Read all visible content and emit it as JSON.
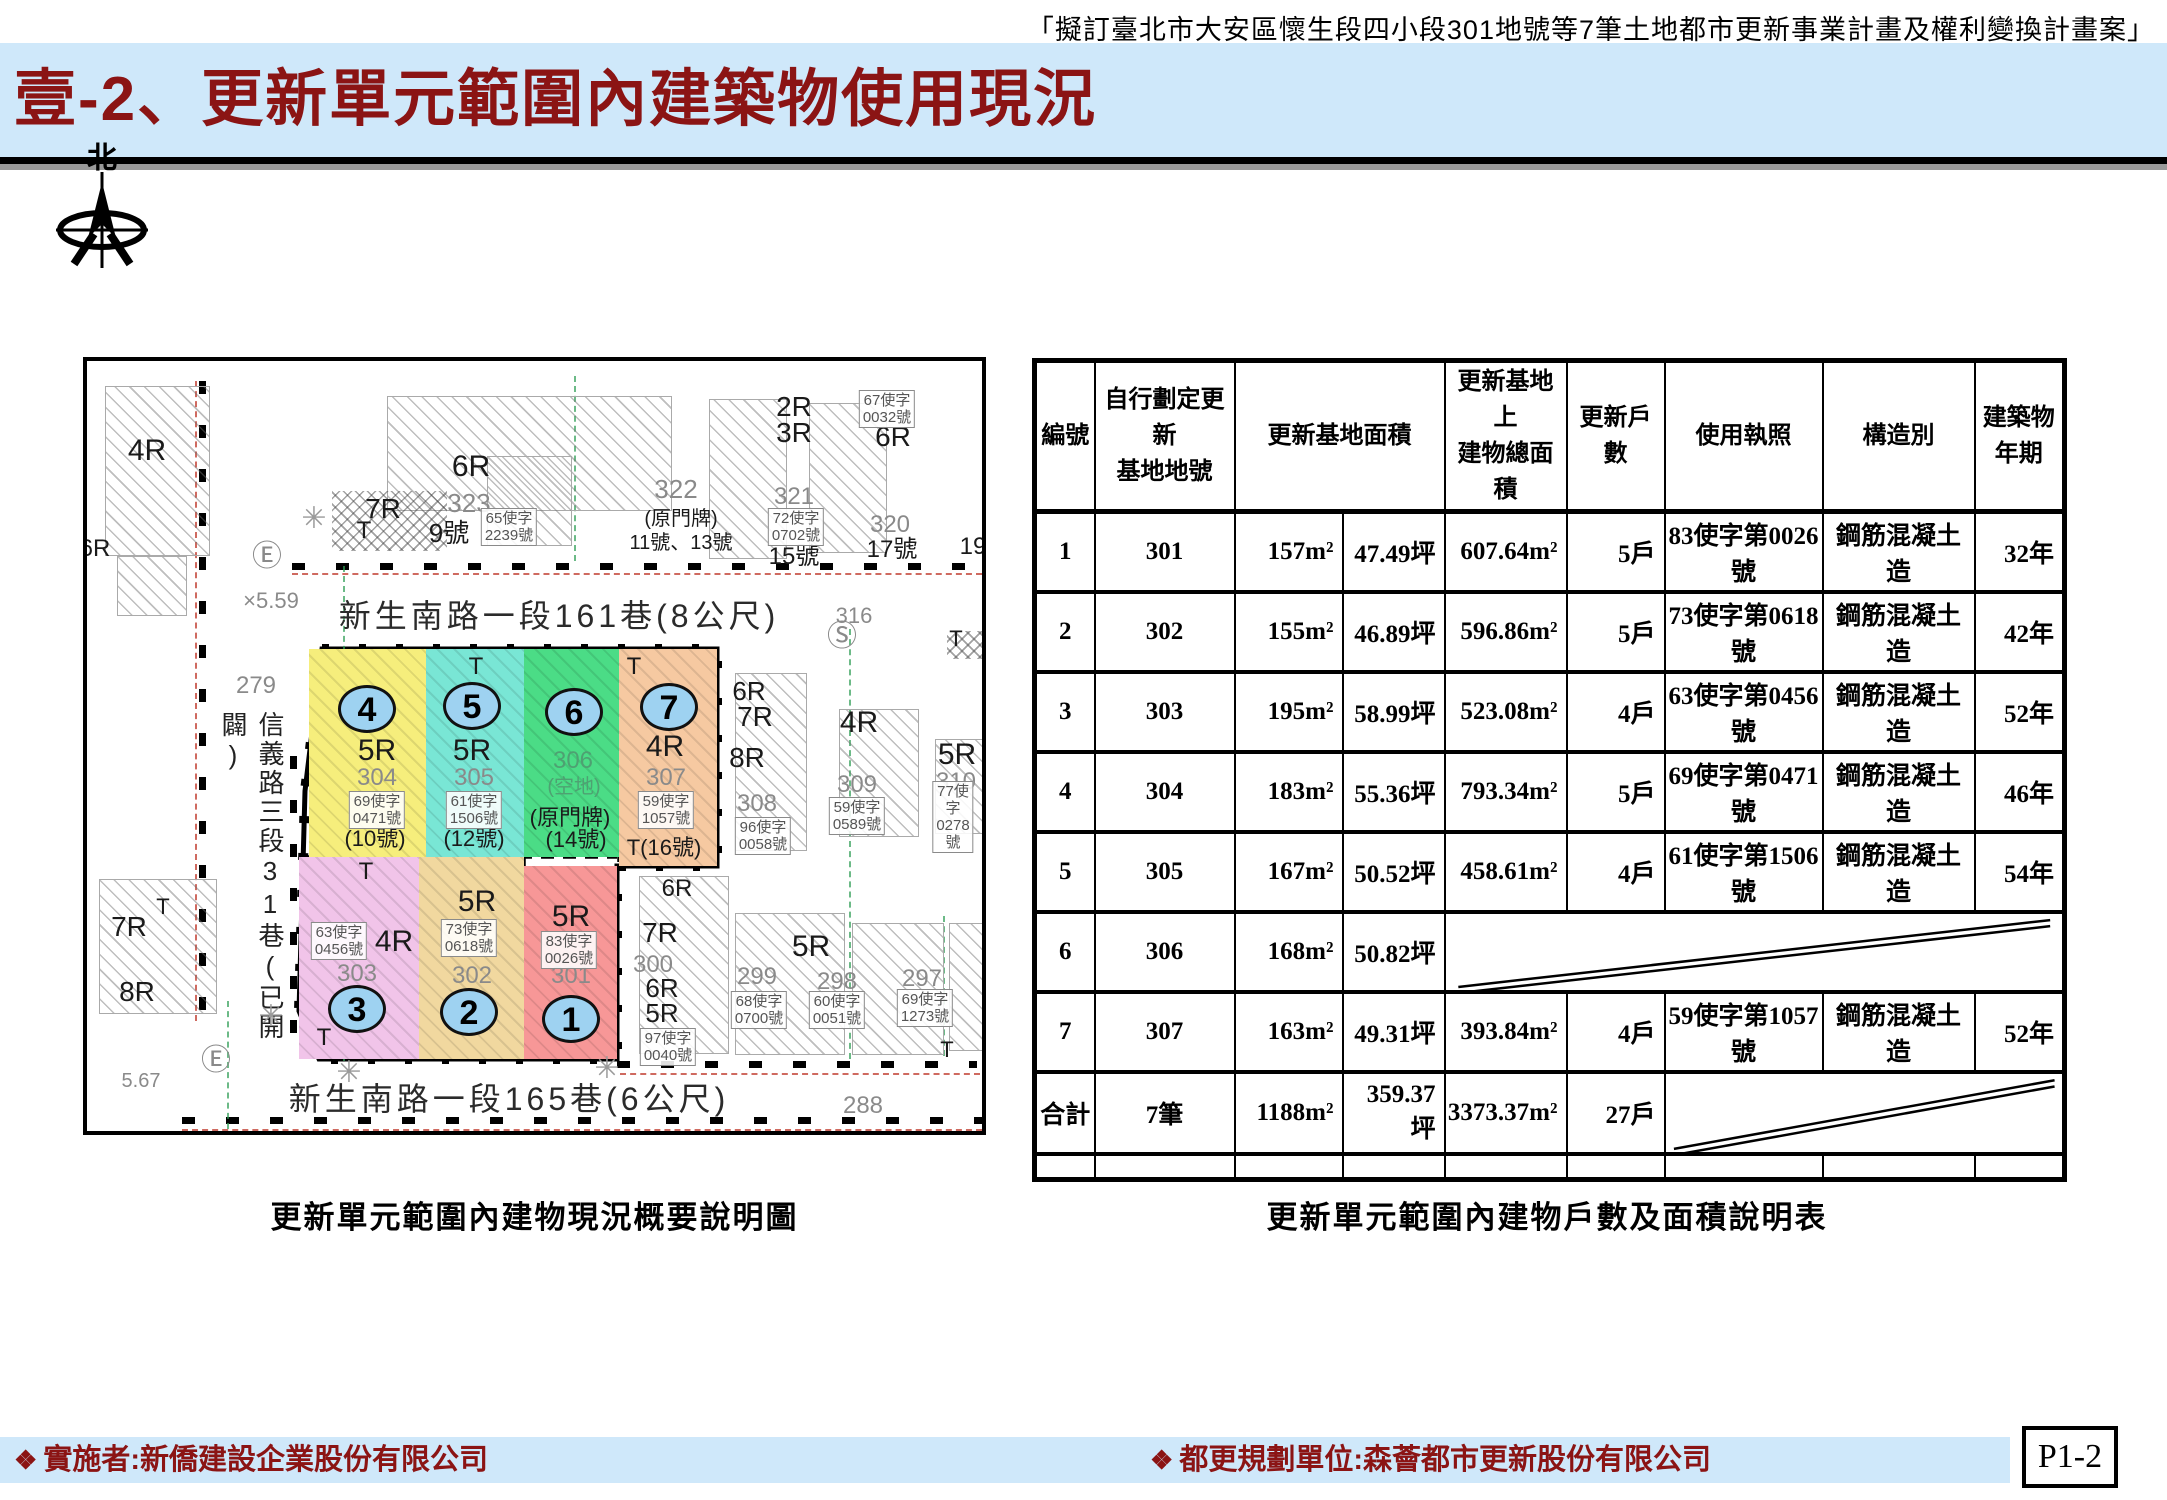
{
  "header": {
    "doc_ref": "「擬訂臺北市大安區懷生段四小段301地號等7筆土地都市更新事業計畫及權利變換計畫案」",
    "title": "壹-2、更新單元範圍內建築物使用現況",
    "accent_color": "#8b1414",
    "band_color": "#cfe8fa"
  },
  "compass": {
    "north_label": "北"
  },
  "map_caption": "更新單元範圍內建物現況概要說明圖",
  "table_caption": "更新單元範圍內建物戶數及面積說明表",
  "map": {
    "roads": [
      {
        "t": "新生南路一段161巷(8公尺)",
        "x": 472,
        "y": 253
      },
      {
        "t": "新生南路一段165巷(6公尺)",
        "x": 422,
        "y": 736
      }
    ],
    "street_vertical": "信義路三段31巷(已開闢)",
    "unit_outline": [
      [
        235,
        288
      ],
      [
        630,
        288
      ],
      [
        630,
        505
      ],
      [
        530,
        505
      ],
      [
        530,
        698
      ],
      [
        232,
        698
      ],
      [
        212,
        650
      ],
      [
        218,
        430
      ]
    ],
    "unit_dashes": [
      [
        339,
        290,
        339,
        496
      ],
      [
        437,
        290,
        437,
        496
      ],
      [
        532,
        290,
        532,
        503
      ],
      [
        212,
        496,
        530,
        496
      ],
      [
        332,
        496,
        332,
        696
      ],
      [
        437,
        496,
        437,
        696
      ]
    ],
    "parcels": [
      {
        "no": "4",
        "color": "#f6ee7c",
        "x": 222,
        "y": 288,
        "w": 117,
        "h": 208,
        "cx": 280,
        "cy": 348
      },
      {
        "no": "5",
        "color": "#79e6d5",
        "x": 339,
        "y": 288,
        "w": 98,
        "h": 208,
        "cx": 385,
        "cy": 345
      },
      {
        "no": "6",
        "color": "#4bdc86",
        "x": 437,
        "y": 288,
        "w": 95,
        "h": 208,
        "cx": 487,
        "cy": 351
      },
      {
        "no": "7",
        "color": "#f6c9a1",
        "x": 532,
        "y": 288,
        "w": 98,
        "h": 217,
        "cx": 582,
        "cy": 346
      },
      {
        "no": "3",
        "color": "#f1c4e9",
        "x": 212,
        "y": 496,
        "w": 120,
        "h": 202,
        "cx": 270,
        "cy": 648
      },
      {
        "no": "2",
        "color": "#f1d89f",
        "x": 332,
        "y": 496,
        "w": 105,
        "h": 202,
        "cx": 382,
        "cy": 651
      },
      {
        "no": "1",
        "color": "#f79797",
        "x": 437,
        "y": 505,
        "w": 93,
        "h": 193,
        "cx": 484,
        "cy": 658
      }
    ],
    "buildings": [
      {
        "x": 18,
        "y": 25,
        "w": 105,
        "h": 170
      },
      {
        "x": 30,
        "y": 195,
        "w": 70,
        "h": 60
      },
      {
        "x": 300,
        "y": 35,
        "w": 285,
        "h": 115
      },
      {
        "x": 400,
        "y": 95,
        "w": 85,
        "h": 90
      },
      {
        "x": 622,
        "y": 38,
        "w": 78,
        "h": 160
      },
      {
        "x": 722,
        "y": 42,
        "w": 78,
        "h": 150
      },
      {
        "x": 860,
        "y": 270,
        "w": 42,
        "h": 28,
        "cross": true
      },
      {
        "x": 648,
        "y": 312,
        "w": 72,
        "h": 178
      },
      {
        "x": 752,
        "y": 348,
        "w": 80,
        "h": 128
      },
      {
        "x": 848,
        "y": 378,
        "w": 80,
        "h": 95
      },
      {
        "x": 12,
        "y": 518,
        "w": 118,
        "h": 135
      },
      {
        "x": 552,
        "y": 515,
        "w": 90,
        "h": 178
      },
      {
        "x": 648,
        "y": 552,
        "w": 110,
        "h": 142
      },
      {
        "x": 765,
        "y": 562,
        "w": 92,
        "h": 132
      },
      {
        "x": 862,
        "y": 562,
        "w": 68,
        "h": 128
      },
      {
        "x": 245,
        "y": 130,
        "w": 115,
        "h": 60,
        "cross": true
      },
      {
        "x": 339,
        "y": 288,
        "w": 98,
        "h": 24,
        "cross": true
      },
      {
        "x": 532,
        "y": 288,
        "w": 34,
        "h": 30,
        "cross": true
      },
      {
        "x": 212,
        "y": 496,
        "w": 120,
        "h": 28,
        "cross": true
      },
      {
        "x": 218,
        "y": 648,
        "w": 55,
        "h": 40,
        "cross": true
      }
    ],
    "labels": [
      {
        "t": "4R",
        "x": 60,
        "y": 90,
        "s": 30
      },
      {
        "t": "7R",
        "x": 296,
        "y": 148,
        "s": 28
      },
      {
        "t": "T",
        "x": 277,
        "y": 170,
        "s": 24
      },
      {
        "t": "6R",
        "x": 384,
        "y": 106,
        "s": 30
      },
      {
        "t": "323",
        "x": 382,
        "y": 142,
        "s": 26,
        "c": "g"
      },
      {
        "t": "9號",
        "x": 362,
        "y": 172,
        "s": 26
      },
      {
        "t": "322",
        "x": 589,
        "y": 128,
        "s": 26,
        "c": "g"
      },
      {
        "t": "(原門牌)",
        "x": 594,
        "y": 158,
        "s": 20
      },
      {
        "t": "11號、13號",
        "x": 594,
        "y": 182,
        "s": 20
      },
      {
        "t": "2R",
        "x": 707,
        "y": 46,
        "s": 28
      },
      {
        "t": "3R",
        "x": 707,
        "y": 72,
        "s": 28
      },
      {
        "t": "6R",
        "x": 806,
        "y": 76,
        "s": 28
      },
      {
        "t": "321",
        "x": 707,
        "y": 136,
        "s": 24,
        "c": "g"
      },
      {
        "t": "15號",
        "x": 707,
        "y": 196,
        "s": 24
      },
      {
        "t": "320",
        "x": 803,
        "y": 164,
        "s": 24,
        "c": "g"
      },
      {
        "t": "17號",
        "x": 805,
        "y": 189,
        "s": 24
      },
      {
        "t": "19",
        "x": 886,
        "y": 186,
        "s": 24
      },
      {
        "t": "316",
        "x": 767,
        "y": 255,
        "s": 22,
        "c": "g"
      },
      {
        "t": "Ⓢ",
        "x": 755,
        "y": 276,
        "s": 30,
        "c": "g"
      },
      {
        "t": "Ⓔ",
        "x": 180,
        "y": 196,
        "s": 30,
        "c": "g"
      },
      {
        "t": "×5.59",
        "x": 184,
        "y": 240,
        "s": 22,
        "c": "g"
      },
      {
        "t": "279",
        "x": 169,
        "y": 325,
        "s": 24,
        "c": "g"
      },
      {
        "t": "T",
        "x": 869,
        "y": 278,
        "s": 22
      },
      {
        "t": "✳",
        "x": 227,
        "y": 158,
        "s": 30,
        "c": "sun"
      },
      {
        "t": "6R",
        "x": 662,
        "y": 330,
        "s": 26
      },
      {
        "t": "7R",
        "x": 668,
        "y": 356,
        "s": 28
      },
      {
        "t": "8R",
        "x": 660,
        "y": 397,
        "s": 28
      },
      {
        "t": "308",
        "x": 670,
        "y": 443,
        "s": 24,
        "c": "g"
      },
      {
        "t": "4R",
        "x": 772,
        "y": 362,
        "s": 30
      },
      {
        "t": "309",
        "x": 770,
        "y": 424,
        "s": 24,
        "c": "g"
      },
      {
        "t": "5R",
        "x": 870,
        "y": 394,
        "s": 30
      },
      {
        "t": "310",
        "x": 869,
        "y": 421,
        "s": 24,
        "c": "g"
      },
      {
        "t": "6R",
        "x": 8,
        "y": 188,
        "s": 24
      },
      {
        "t": "7R",
        "x": 42,
        "y": 566,
        "s": 28
      },
      {
        "t": "T",
        "x": 76,
        "y": 546,
        "s": 22
      },
      {
        "t": "8R",
        "x": 50,
        "y": 631,
        "s": 28
      },
      {
        "t": "5.67",
        "x": 54,
        "y": 720,
        "s": 20,
        "c": "g"
      },
      {
        "t": "Ⓔ",
        "x": 129,
        "y": 700,
        "s": 30,
        "c": "g"
      },
      {
        "t": "✳",
        "x": 184,
        "y": 656,
        "s": 30,
        "c": "sun"
      },
      {
        "t": "✳",
        "x": 262,
        "y": 712,
        "s": 30,
        "c": "sun"
      },
      {
        "t": "✳",
        "x": 520,
        "y": 708,
        "s": 30,
        "c": "sun"
      },
      {
        "t": "6R",
        "x": 590,
        "y": 528,
        "s": 24
      },
      {
        "t": "7R",
        "x": 573,
        "y": 572,
        "s": 28
      },
      {
        "t": "300",
        "x": 566,
        "y": 604,
        "s": 24,
        "c": "g"
      },
      {
        "t": "6R",
        "x": 575,
        "y": 627,
        "s": 26
      },
      {
        "t": "5R",
        "x": 575,
        "y": 652,
        "s": 26
      },
      {
        "t": "5R",
        "x": 724,
        "y": 586,
        "s": 30
      },
      {
        "t": "299",
        "x": 670,
        "y": 616,
        "s": 24,
        "c": "g"
      },
      {
        "t": "298",
        "x": 750,
        "y": 621,
        "s": 24,
        "c": "g"
      },
      {
        "t": "297",
        "x": 835,
        "y": 618,
        "s": 24,
        "c": "g"
      },
      {
        "t": "T",
        "x": 860,
        "y": 689,
        "s": 22
      },
      {
        "t": "288",
        "x": 776,
        "y": 745,
        "s": 24,
        "c": "g"
      },
      {
        "t": "5R",
        "x": 290,
        "y": 390,
        "s": 30
      },
      {
        "t": "304",
        "x": 290,
        "y": 417,
        "s": 24,
        "c": "g"
      },
      {
        "t": "(10號)",
        "x": 288,
        "y": 478,
        "s": 22
      },
      {
        "t": "T",
        "x": 389,
        "y": 306,
        "s": 24
      },
      {
        "t": "5R",
        "x": 385,
        "y": 390,
        "s": 30
      },
      {
        "t": "305",
        "x": 387,
        "y": 417,
        "s": 24,
        "c": "g"
      },
      {
        "t": "(12號)",
        "x": 387,
        "y": 478,
        "s": 22
      },
      {
        "t": "306",
        "x": 486,
        "y": 400,
        "s": 24,
        "c": "grn"
      },
      {
        "t": "(空地)",
        "x": 487,
        "y": 426,
        "s": 20,
        "c": "grn"
      },
      {
        "t": "(原門牌)",
        "x": 483,
        "y": 457,
        "s": 22
      },
      {
        "t": "(14號)",
        "x": 489,
        "y": 479,
        "s": 22
      },
      {
        "t": "T",
        "x": 547,
        "y": 306,
        "s": 24
      },
      {
        "t": "4R",
        "x": 578,
        "y": 386,
        "s": 30
      },
      {
        "t": "307",
        "x": 579,
        "y": 417,
        "s": 24,
        "c": "g"
      },
      {
        "t": "T(16號)",
        "x": 577,
        "y": 487,
        "s": 22
      },
      {
        "t": "T",
        "x": 279,
        "y": 511,
        "s": 24
      },
      {
        "t": "4R",
        "x": 307,
        "y": 581,
        "s": 30
      },
      {
        "t": "303",
        "x": 270,
        "y": 613,
        "s": 24,
        "c": "g"
      },
      {
        "t": "T",
        "x": 237,
        "y": 677,
        "s": 24
      },
      {
        "t": "5R",
        "x": 390,
        "y": 541,
        "s": 30
      },
      {
        "t": "302",
        "x": 385,
        "y": 615,
        "s": 24,
        "c": "g"
      },
      {
        "t": "5R",
        "x": 484,
        "y": 556,
        "s": 30
      },
      {
        "t": "301",
        "x": 484,
        "y": 615,
        "s": 24,
        "c": "g"
      }
    ],
    "boxed": [
      {
        "l": "65使字\n2239號",
        "x": 422,
        "y": 166
      },
      {
        "l": "67使字\n0032號",
        "x": 800,
        "y": 48
      },
      {
        "l": "72使字\n0702號",
        "x": 709,
        "y": 166
      },
      {
        "l": "96使字\n0058號",
        "x": 676,
        "y": 475
      },
      {
        "l": "59使字\n0589號",
        "x": 770,
        "y": 455
      },
      {
        "l": "77使字\n0278號",
        "x": 866,
        "y": 456
      },
      {
        "l": "97使字\n0040號",
        "x": 581,
        "y": 686
      },
      {
        "l": "68使字\n0700號",
        "x": 672,
        "y": 649
      },
      {
        "l": "60使字\n0051號",
        "x": 750,
        "y": 649
      },
      {
        "l": "69使字\n1273號",
        "x": 838,
        "y": 647
      },
      {
        "l": "69使字\n0471號",
        "x": 290,
        "y": 449
      },
      {
        "l": "61使字\n1506號",
        "x": 387,
        "y": 449
      },
      {
        "l": "59使字\n1057號",
        "x": 579,
        "y": 449
      },
      {
        "l": "63使字\n0456號",
        "x": 252,
        "y": 580
      },
      {
        "l": "73使字\n0618號",
        "x": 382,
        "y": 577
      },
      {
        "l": "83使字\n0026號",
        "x": 482,
        "y": 589
      }
    ],
    "tick_strips": [
      {
        "x": 205,
        "y": 202,
        "len": 690
      },
      {
        "x": 530,
        "y": 700,
        "len": 360
      },
      {
        "x": 95,
        "y": 756,
        "len": 800
      },
      {
        "x": 112,
        "y": 20,
        "len": 640,
        "v": true
      },
      {
        "x": 203,
        "y": 395,
        "len": 295,
        "v": true
      }
    ],
    "red_lines": [
      {
        "x": 205,
        "y": 212,
        "len": 690
      },
      {
        "x": 95,
        "y": 768,
        "len": 800
      },
      {
        "x": 533,
        "y": 712,
        "len": 360
      },
      {
        "x": 108,
        "y": 20,
        "len": 640,
        "v": true
      }
    ],
    "green_lines": [
      {
        "x": 256,
        "y": 205,
        "len": 495
      },
      {
        "x": 487,
        "y": 15,
        "len": 185
      },
      {
        "x": 762,
        "y": 268,
        "len": 430
      },
      {
        "x": 856,
        "y": 555,
        "len": 140
      },
      {
        "x": 140,
        "y": 640,
        "len": 128
      }
    ]
  },
  "table": {
    "col_widths": [
      60,
      140,
      108,
      102,
      122,
      98,
      158,
      152,
      90
    ],
    "header_height": 98,
    "row_heights": [
      80,
      80,
      80,
      80,
      80,
      80,
      80,
      82,
      26
    ],
    "headers": [
      {
        "label": "編號"
      },
      {
        "label": "自行劃定更新\n基地地號"
      },
      {
        "label": "更新基地面積",
        "span": 2
      },
      {
        "label": "更新基地上\n建物總面積"
      },
      {
        "label": "更新戶數"
      },
      {
        "label": "使用執照"
      },
      {
        "label": "構造別"
      },
      {
        "label": "建築物\n年期"
      }
    ],
    "rows": [
      [
        "1",
        "301",
        "157m²",
        "47.49坪",
        "607.64m²",
        "5戶",
        "83使字第0026號",
        "鋼筋混凝土造",
        "32年"
      ],
      [
        "2",
        "302",
        "155m²",
        "46.89坪",
        "596.86m²",
        "5戶",
        "73使字第0618號",
        "鋼筋混凝土造",
        "42年"
      ],
      [
        "3",
        "303",
        "195m²",
        "58.99坪",
        "523.08m²",
        "4戶",
        "63使字第0456號",
        "鋼筋混凝土造",
        "52年"
      ],
      [
        "4",
        "304",
        "183m²",
        "55.36坪",
        "793.34m²",
        "5戶",
        "69使字第0471號",
        "鋼筋混凝土造",
        "46年"
      ],
      [
        "5",
        "305",
        "167m²",
        "50.52坪",
        "458.61m²",
        "4戶",
        "61使字第1506號",
        "鋼筋混凝土造",
        "54年"
      ],
      [
        "6",
        "306",
        "168m²",
        "50.82坪",
        {
          "diag": 5
        }
      ],
      [
        "7",
        "307",
        "163m²",
        "49.31坪",
        "393.84m²",
        "4戶",
        "59使字第1057號",
        "鋼筋混凝土造",
        "52年"
      ],
      [
        "合計",
        "7筆",
        "1188m²",
        "359.37坪",
        "3373.37m²",
        "27戶",
        {
          "diag": 3
        }
      ],
      [
        "",
        "",
        "",
        "",
        "",
        "",
        "",
        "",
        ""
      ]
    ]
  },
  "footer": {
    "marker": "❖",
    "implementer": "實施者:新僑建設企業股份有限公司",
    "planner": "都更規劃單位:森薈都市更新股份有限公司",
    "page_no": "P1-2"
  }
}
